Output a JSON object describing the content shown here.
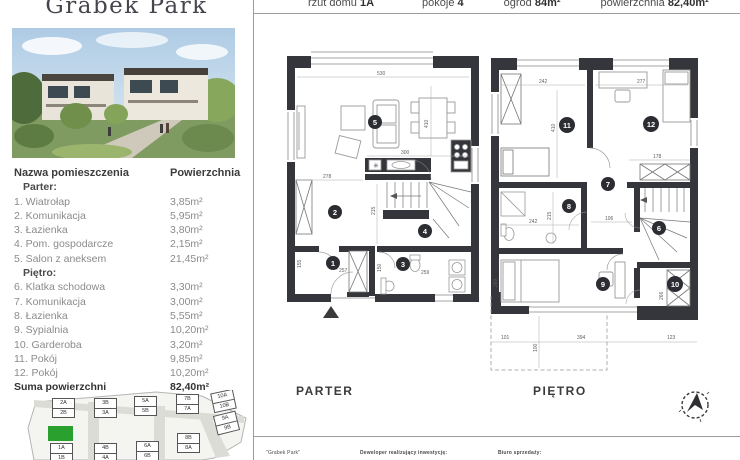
{
  "brand": {
    "title": "Grabek Park"
  },
  "specs": {
    "plan_label": "rzut domu",
    "plan_value": "1A",
    "rooms_label": "pokoje",
    "rooms_value": "4",
    "garden_label": "ogród",
    "garden_value": "84m²",
    "area_label": "powierzchnia",
    "area_value": "82,40m²"
  },
  "room_table": {
    "col_name": "Nazwa pomieszczenia",
    "col_area": "Powierzchnia",
    "section_parter": "Parter:",
    "section_pietro": "Piętro:",
    "parter_rows": [
      {
        "name": "1. Wiatrołap",
        "area": "3,85m²"
      },
      {
        "name": "2. Komunikacja",
        "area": "5,95m²"
      },
      {
        "name": "3. Łazienka",
        "area": "3,80m²"
      },
      {
        "name": "4. Pom. gospodarcze",
        "area": "2,15m²"
      },
      {
        "name": "5. Salon z aneksem",
        "area": "21,45m²"
      }
    ],
    "pietro_rows": [
      {
        "name": "6. Klatka schodowa",
        "area": "3,30m²"
      },
      {
        "name": "7. Komunikacja",
        "area": "3,00m²"
      },
      {
        "name": "8. Łazienka",
        "area": "5,55m²"
      },
      {
        "name": "9. Sypialnia",
        "area": "10,20m²"
      },
      {
        "name": "10. Garderoba",
        "area": "3,20m²"
      },
      {
        "name": "11. Pokój",
        "area": "9,85m²"
      },
      {
        "name": "12. Pokój",
        "area": "10,20m²"
      }
    ],
    "total_label": "Suma powierzchni",
    "total_value": "82,40m²"
  },
  "plans": {
    "parter": {
      "label": "PARTER",
      "rooms": [
        "1",
        "2",
        "3",
        "4",
        "5"
      ],
      "dims": [
        "530",
        "410",
        "300",
        "278",
        "215",
        "257",
        "155",
        "259",
        "150"
      ]
    },
    "pietro": {
      "label": "PIĘTRO",
      "rooms": [
        "6",
        "7",
        "8",
        "9",
        "10",
        "11",
        "12"
      ],
      "dims": [
        "242",
        "277",
        "410",
        "178",
        "215",
        "242",
        "106",
        "260",
        "266",
        "101",
        "394",
        "123",
        "100"
      ]
    }
  },
  "site_map": {
    "highlighted_plot": "1A",
    "highlight_color": "#2aa12e",
    "plots": [
      [
        "2A",
        "2B"
      ],
      [
        "3B",
        "3A"
      ],
      [
        "5A",
        "5B"
      ],
      [
        "7B",
        "7A"
      ],
      [
        "10A",
        "10B"
      ],
      [
        "1A",
        "1B"
      ],
      [
        "4B",
        "4A"
      ],
      [
        "6A",
        "6B"
      ],
      [
        "8B",
        "8A"
      ],
      [
        "9A",
        "9B"
      ]
    ]
  },
  "footer": {
    "project": "\"Grabek Park\"",
    "developer_label": "Deweloper realizujący inwestycję:",
    "office_label": "Biuro sprzedaży:"
  }
}
